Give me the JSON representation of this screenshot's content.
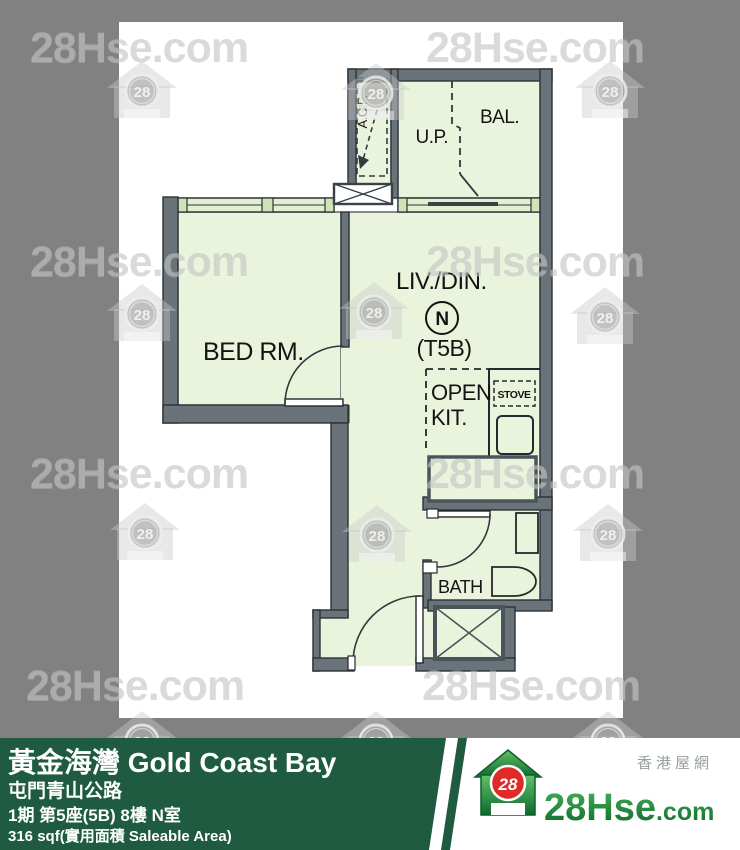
{
  "watermark": {
    "text": "28Hse.com",
    "logo_number": "28"
  },
  "plan": {
    "labels": {
      "bedroom": "BED RM.",
      "living_dining": "LIV./DIN.",
      "flat_letter": "N",
      "unit_type": "(T5B)",
      "open_kitchen_line1": "OPEN",
      "open_kitchen_line2": "KIT.",
      "stove": "STOVE",
      "bath": "BATH",
      "balcony": "BAL.",
      "utility_platform": "U.P.",
      "ac_platform": "A.C.P."
    },
    "colors": {
      "room_fill": "#eaf4dc",
      "wall_fill": "#6a737a",
      "wall_outline": "#2b3237"
    }
  },
  "footer": {
    "estate_name": "黃金海灣 Gold Coast Bay",
    "address": "屯門青山公路",
    "unit_info": "1期 第5座(5B) 8樓 N室",
    "area_info": "316 sqf(實用面積 Saleable Area)",
    "bar_color": "#1e5b40"
  },
  "brand": {
    "logo_number": "28",
    "site_name_main": "28Hse",
    "site_name_suffix": ".com",
    "site_tagline": "香港屋網"
  }
}
